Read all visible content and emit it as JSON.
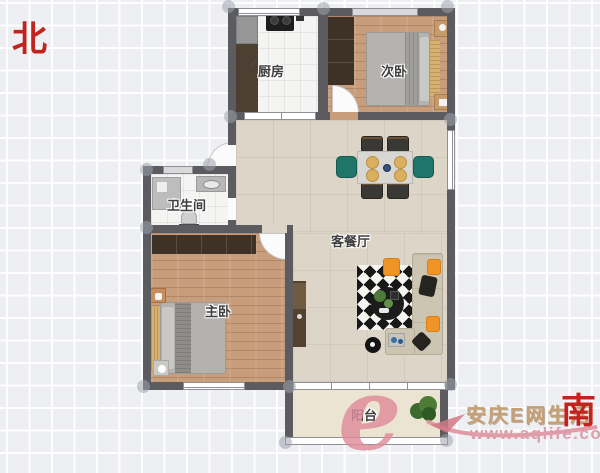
{
  "compass": {
    "north_label": "北",
    "south_label": "南"
  },
  "rooms": {
    "kitchen": {
      "label": "厨房"
    },
    "second_bedroom": {
      "label": "次卧"
    },
    "bathroom": {
      "label": "卫生间"
    },
    "living_dining": {
      "label": "客餐厅"
    },
    "master_bedroom": {
      "label": "主卧"
    },
    "balcony": {
      "label": "阳台"
    }
  },
  "watermark": {
    "logo_letter": "e",
    "site_name": "安庆E网生活",
    "site_url": "www.aqlife.com"
  },
  "colors": {
    "wall": "#5b5b60",
    "compass_red": "#c3231d",
    "accent_orange": "#f09428",
    "accent_teal": "#20756a",
    "watermark_pink": "#dc9fab",
    "watermark_tan": "#c4a074"
  }
}
